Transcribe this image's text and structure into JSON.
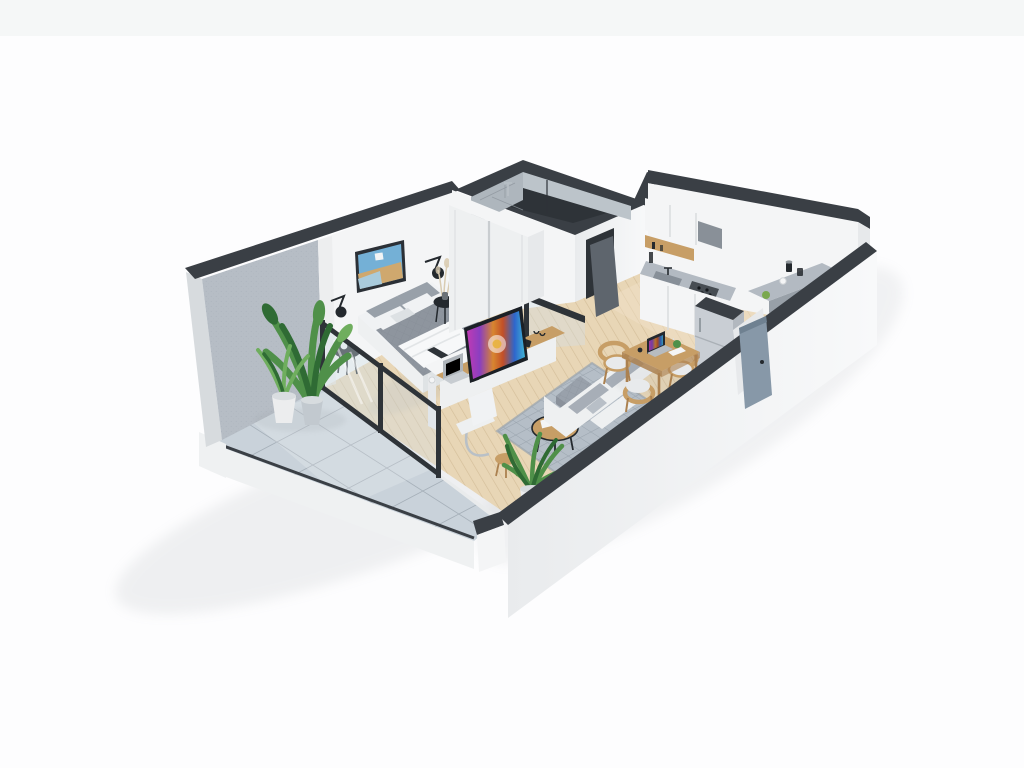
{
  "meta": {
    "description": "3D isometric cutaway render of a small studio apartment floor plan viewed from above, on a plain white background",
    "render_style": "architectural 3D floor plan, open-top walls with dark cut edges"
  },
  "palette": {
    "bg": "#fdfdfe",
    "bg_band": "#f1f3f4",
    "ground_shadow": "#9aa0a6",
    "wall_top": "#3a3f45",
    "wall_white": "#f4f5f6",
    "wall_shade": "#e7e9eb",
    "wall_end": "#d7dbde",
    "concrete": "#b6bdc5",
    "concrete_dot": "#98a1aa",
    "tile": "#c9d2da",
    "grout": "#a6b0b9",
    "slab": "#eff1f2",
    "platform": "#e9ebec",
    "wood": "#e8d6b6",
    "wood_line": "#d4be99",
    "wood_light": "#f1e3c9",
    "glass": "#d3e0e8",
    "glass_frame": "#2e3338",
    "rug": "#b5bec7",
    "rug_line": "#9aa4ae",
    "sofa": "#eef0f1",
    "sofa_shade": "#dfe3e5",
    "cushion": "#a7aeb7",
    "pouf": "#99a1ab",
    "duvet": "#8e959e",
    "duvet_line": "#7d848d",
    "pillow_gray": "#98a0a9",
    "pillow_white": "#f0f2f4",
    "throw": "#f7f8f9",
    "wood_furn": "#c79e66",
    "wood_furn_dark": "#ab8150",
    "black": "#24292e",
    "chrome": "#b9c0c6",
    "counter": "#b3bac2",
    "counter_dark": "#98a0a8",
    "steel": "#aeb4ba",
    "cooktop": "#474d53",
    "fridge": "#c9ced4",
    "fridge_side": "#b2b8bf",
    "door_entry": "#8798a8",
    "door_bath": "#5e656d",
    "plant_dark": "#2f6b34",
    "plant_mid": "#4f9049",
    "plant_light": "#6fae5e",
    "pot_gray": "#c2c9cf",
    "pot_white": "#ecedee",
    "tv_frame": "#1b2026",
    "art_sky": "#74b0d6",
    "art_sea": "#a9cbdc",
    "art_sand": "#cfa86e",
    "art_frame": "#2b3036",
    "laptop": "#aeb4ba",
    "pampas": "#d9ccb2",
    "apple": "#7aa84e",
    "bath_wall_a": "#aeb6bd",
    "bath_wall_b": "#bcc4ca",
    "bath_floor": "#2e3338"
  },
  "scene": {
    "rooms": [
      {
        "id": "balcony",
        "label": "Balcony",
        "floor": "gray ceramic tile"
      },
      {
        "id": "bedroom",
        "label": "Bedroom",
        "floor": "light oak plank"
      },
      {
        "id": "bathroom",
        "label": "Bathroom",
        "floor": "dark tile, tiled walls"
      },
      {
        "id": "kitchen",
        "label": "Kitchen",
        "floor": "light oak plank"
      },
      {
        "id": "dining",
        "label": "Dining area",
        "floor": "light oak plank"
      },
      {
        "id": "living",
        "label": "Living area",
        "floor": "light oak plank"
      },
      {
        "id": "entry",
        "label": "Entry hall",
        "floor": "light oak plank"
      }
    ],
    "furniture": {
      "balcony": [
        "two potted green plants",
        "glass balustrade with dark frame"
      ],
      "bedroom": [
        "double bed with gray duvet and white throw",
        "gray and white pillows",
        "two black round side tables",
        "two black wall sconce lamps",
        "framed seascape artwork",
        "vase with dried pampas grass",
        "white sliding-door wardrobe"
      ],
      "bathroom": [
        "walk-in shower with rain head",
        "glass screen"
      ],
      "kitchen": [
        "white upper cabinets",
        "extractor hood",
        "open wood shelf",
        "gray countertop with sink",
        "gas cooktop with oven",
        "white lower cabinets",
        "tall fridge freezer"
      ],
      "dining": [
        "square wood dining table",
        "three rounded wood chairs",
        "open laptop",
        "papers",
        "plant sprig"
      ],
      "living": [
        "flat TV with colorful screen on low console",
        "desk with laptop, smartphone and cup",
        "white cantilever desk chair",
        "small wood stool",
        "round wood coffee table with black bowl and white book",
        "quilted gray pouf",
        "gray patterned area rug",
        "light three-seat sofa with gray cushions",
        "tall potted plant"
      ],
      "entry": [
        "open blue-gray entry door",
        "wall bar counter with two jars, cup and green apple"
      ]
    }
  }
}
